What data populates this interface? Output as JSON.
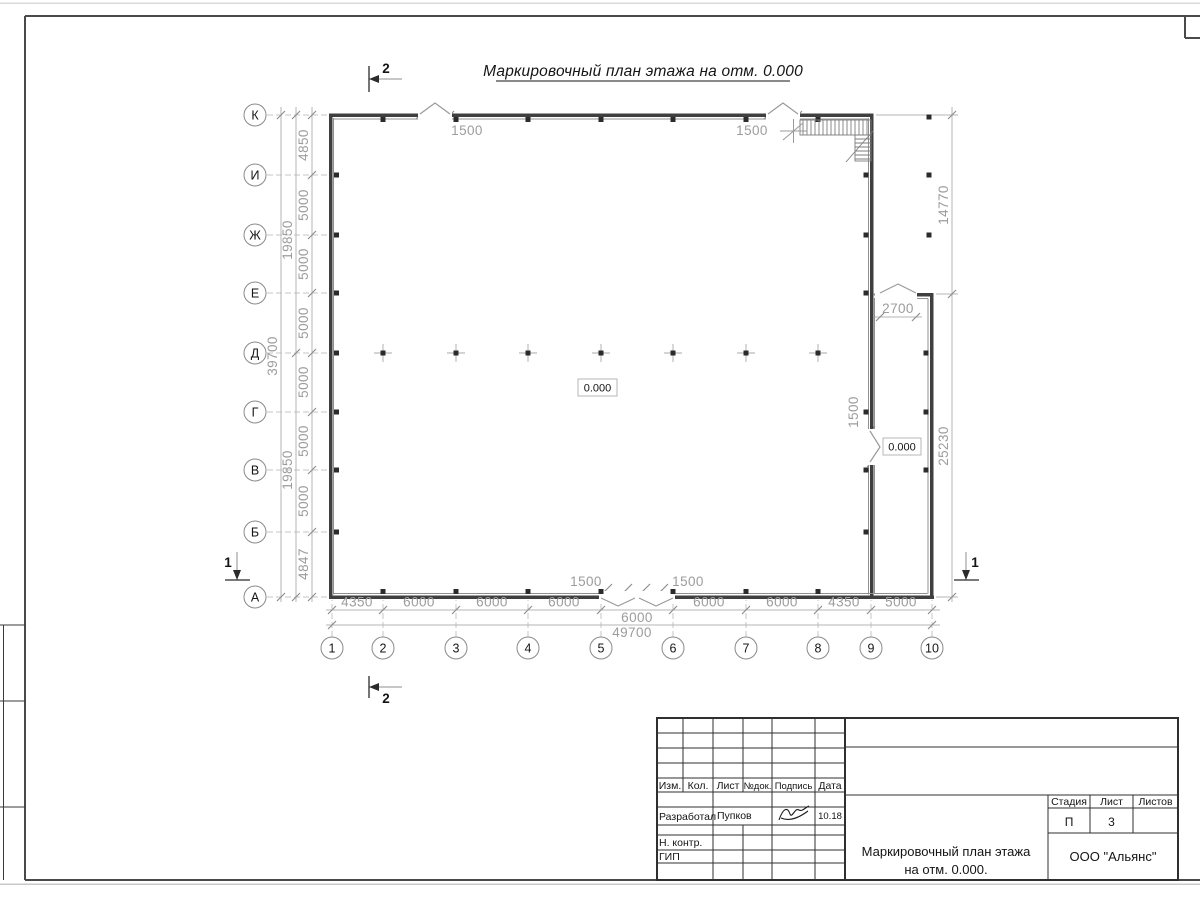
{
  "title": "Маркировочный план этажа на отм. 0.000",
  "plan": {
    "axes_rows": [
      "К",
      "И",
      "Ж",
      "Е",
      "Д",
      "Г",
      "В",
      "Б",
      "А"
    ],
    "axes_cols": [
      "1",
      "2",
      "3",
      "4",
      "5",
      "6",
      "7",
      "8",
      "9",
      "10"
    ],
    "dims_left": [
      "4850",
      "5000",
      "5000",
      "5000",
      "5000",
      "5000",
      "5000",
      "4847"
    ],
    "dims_left_groups": [
      "19850",
      "19850"
    ],
    "dims_left_total": "39700",
    "dims_bottom": [
      "4350",
      "6000",
      "6000",
      "6000",
      "6000",
      "6000",
      "6000",
      "4350",
      "5000"
    ],
    "dims_bottom_total": "49700",
    "dim_right_upper": "14770",
    "dim_right_lower": "25230",
    "dim_annex_opening": "2700",
    "gate_top_left": "1500",
    "gate_top_right": "1500",
    "gate_bottom_left": "1500",
    "gate_bottom_right": "1500",
    "door_side": "1500",
    "level_main": "0.000",
    "level_annex": "0.000",
    "section_top": "2",
    "section_bottom": "2",
    "section_left": "1",
    "section_right": "1"
  },
  "title_block": {
    "headers": [
      "Изм.",
      "Кол.",
      "Лист",
      "№док.",
      "Подпись",
      "Дата"
    ],
    "developer_label": "Разработал",
    "developer_name": "Пупков",
    "developer_date": "10.18",
    "ncontrol_label": "Н. контр.",
    "gip_label": "ГИП",
    "stage_label": "Стадия",
    "sheet_label": "Лист",
    "sheets_label": "Листов",
    "stage_value": "П",
    "sheet_value": "3",
    "doc_title_line1": "Маркировочный план этажа",
    "doc_title_line2": "на отм. 0.000.",
    "company": "ООО \"Альянс\""
  },
  "colors": {
    "wall": "#3f3f3f",
    "wall_inner": "#909090",
    "dim_line": "#b5b5b5",
    "dim_text": "#9c9c9c",
    "frame": "#4a4a4a"
  }
}
